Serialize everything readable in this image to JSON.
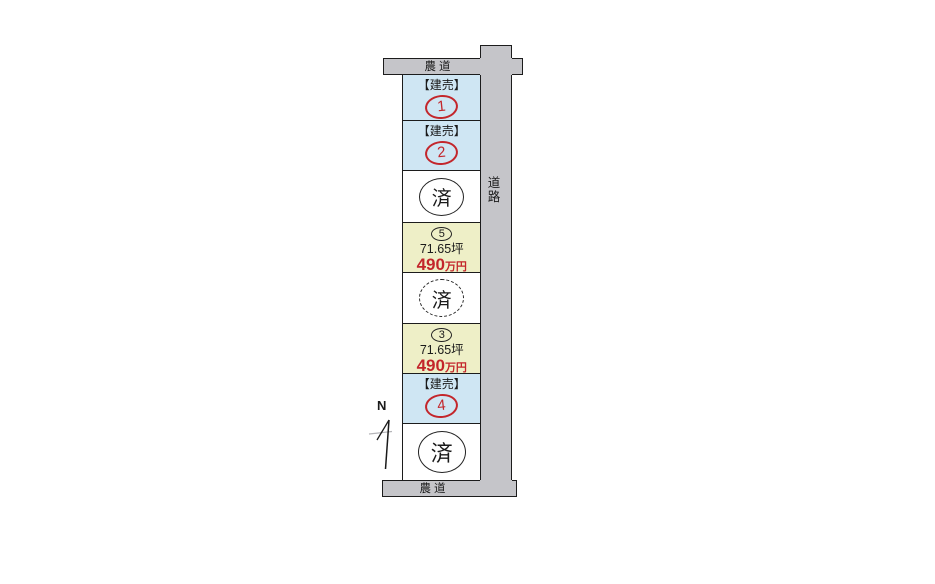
{
  "diagram": {
    "type": "real-estate-lot-plan",
    "colors": {
      "road_fill": "#c5c5c9",
      "lot_blue": "#cfe6f3",
      "lot_yellow": "#eeefc7",
      "accent_red": "#c3262b",
      "line": "#1c1c1c"
    },
    "roads": {
      "top_label": "農道",
      "bottom_label": "農道",
      "side_label": "道路"
    },
    "north_label": "N",
    "lots": [
      {
        "type": "kenbai",
        "tag": "【建売】",
        "number": "1"
      },
      {
        "type": "kenbai",
        "tag": "【建売】",
        "number": "2"
      },
      {
        "type": "sold",
        "mark": "済",
        "circle_style": "solid"
      },
      {
        "type": "price",
        "number": "5",
        "area": "71.65坪",
        "price_value": "490",
        "price_unit": "万円"
      },
      {
        "type": "sold",
        "mark": "済",
        "circle_style": "dashed"
      },
      {
        "type": "price",
        "number": "3",
        "area": "71.65坪",
        "price_value": "490",
        "price_unit": "万円"
      },
      {
        "type": "kenbai",
        "tag": "【建売】",
        "number": "4"
      },
      {
        "type": "sold",
        "mark": "済",
        "circle_style": "solid"
      }
    ]
  }
}
